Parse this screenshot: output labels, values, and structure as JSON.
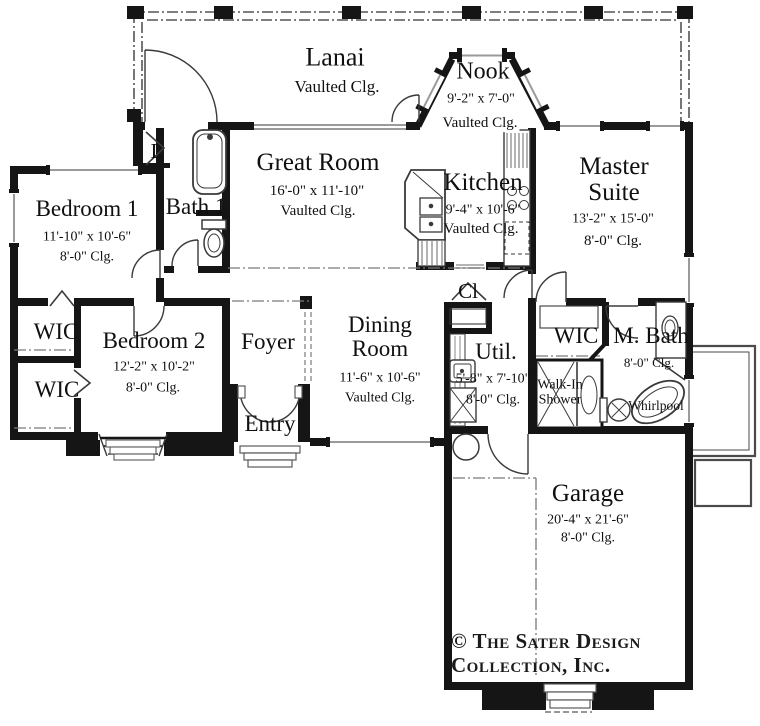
{
  "plan": {
    "title": "single-story floor plan",
    "rooms": {
      "lanai": {
        "name": "Lanai",
        "clg": "Vaulted Clg."
      },
      "nook": {
        "name": "Nook",
        "dims": "9'-2\" x 7'-0\"",
        "clg": "Vaulted Clg."
      },
      "great_room": {
        "name": "Great Room",
        "dims": "16'-0\" x 11'-10\"",
        "clg": "Vaulted Clg."
      },
      "kitchen": {
        "name": "Kitchen",
        "dims": "9'-4\" x 10'-6\"",
        "clg": "Vaulted Clg."
      },
      "master_suite": {
        "name": "Master Suite",
        "dims": "13'-2\" x 15'-0\"",
        "clg": "8'-0\" Clg."
      },
      "bedroom_1": {
        "name": "Bedroom 1",
        "dims": "11'-10\" x 10'-6\"",
        "clg": "8'-0\" Clg."
      },
      "bath_1": {
        "name": "Bath 1"
      },
      "laundry": {
        "name": "L"
      },
      "wic_1": {
        "name": "WIC"
      },
      "wic_2": {
        "name": "WIC"
      },
      "bedroom_2": {
        "name": "Bedroom 2",
        "dims": "12'-2\" x 10'-2\"",
        "clg": "8'-0\" Clg."
      },
      "foyer": {
        "name": "Foyer"
      },
      "entry": {
        "name": "Entry"
      },
      "dining_room": {
        "name": "Dining Room",
        "dims": "11'-6\" x 10'-6\"",
        "clg": "Vaulted Clg."
      },
      "closet": {
        "name": "Cl"
      },
      "utility": {
        "name": "Util.",
        "dims": "5'-8\" x 7'-10\"",
        "clg": "8'-0\" Clg."
      },
      "wic_master": {
        "name": "WIC"
      },
      "m_bath": {
        "name": "M. Bath",
        "clg": "8'-0\" Clg."
      },
      "walk_in_shower": {
        "name": "Walk-In Shower"
      },
      "whirlpool": {
        "name": "Whirlpool"
      },
      "garage": {
        "name": "Garage",
        "dims": "20'-4\" x 21'-6\"",
        "clg": "8'-0\" Clg."
      }
    },
    "copyright": {
      "line1": "© The Sater Design",
      "line2": "Collection, Inc."
    },
    "colors": {
      "wall": "#151515",
      "thin_line": "#3a3a3a",
      "glass_gray": "#9a9a9a",
      "screen_line": "#555555"
    }
  }
}
